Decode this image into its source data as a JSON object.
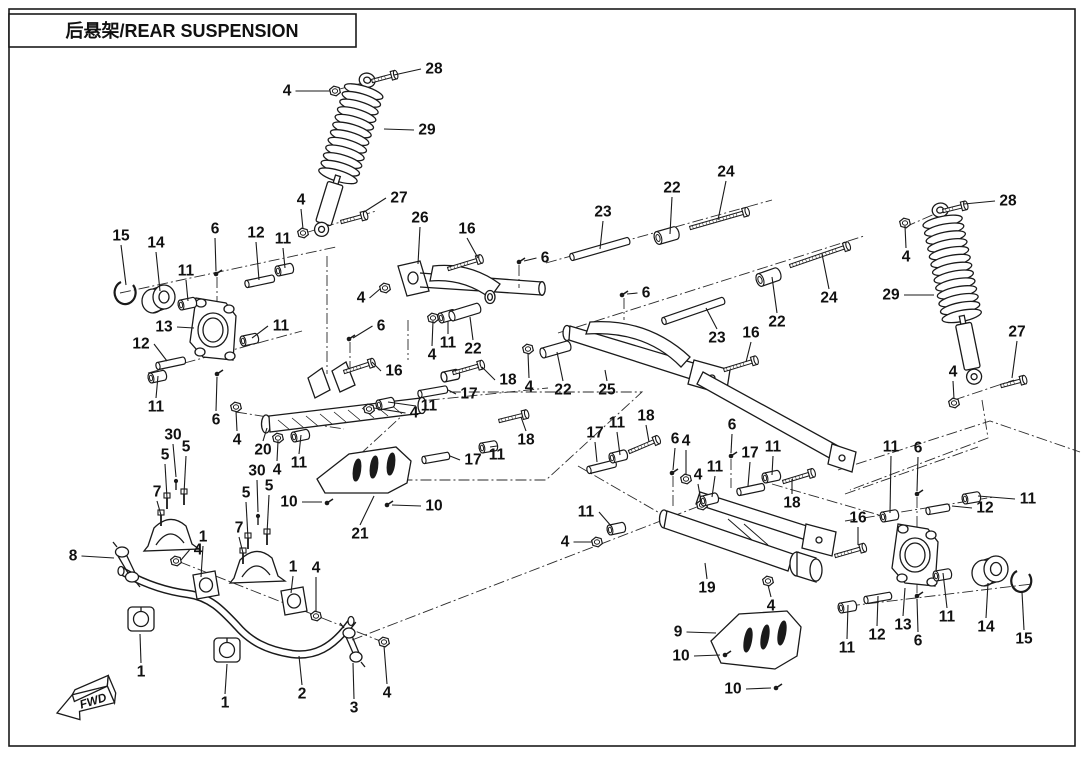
{
  "title": "后悬架/REAR SUSPENSION",
  "fwd_label": "FWD",
  "ink_color": "#1a1a1a",
  "callouts": [
    {
      "n": "28",
      "x": 434,
      "y": 69,
      "tx": 394,
      "ty": 75,
      "part": {
        "t": "bolt",
        "x": 372,
        "y": 81,
        "a": -15,
        "l": 20
      }
    },
    {
      "n": "4",
      "x": 287,
      "y": 91,
      "tx": 330,
      "ty": 91,
      "part": {
        "t": "nut",
        "x": 335,
        "y": 91
      }
    },
    {
      "n": "29",
      "x": 427,
      "y": 130,
      "tx": 384,
      "ty": 129
    },
    {
      "n": "4",
      "x": 301,
      "y": 200,
      "tx": 303,
      "ty": 229,
      "part": {
        "t": "nut",
        "x": 303,
        "y": 233
      }
    },
    {
      "n": "27",
      "x": 399,
      "y": 198,
      "tx": 364,
      "ty": 212,
      "part": {
        "t": "bolt",
        "x": 341,
        "y": 222,
        "a": -15,
        "l": 21
      }
    },
    {
      "n": "26",
      "x": 420,
      "y": 218,
      "tx": 418,
      "ty": 264
    },
    {
      "n": "16",
      "x": 467,
      "y": 229,
      "tx": 478,
      "ty": 258,
      "part": {
        "t": "bolt",
        "x": 448,
        "y": 269,
        "a": -17,
        "l": 30
      }
    },
    {
      "n": "6",
      "x": 545,
      "y": 258,
      "tx": 524,
      "ty": 261,
      "part": {
        "t": "screw",
        "x": 519,
        "y": 262
      }
    },
    {
      "n": "23",
      "x": 603,
      "y": 212,
      "tx": 600,
      "ty": 249,
      "part": {
        "t": "sleeve",
        "x": 572,
        "y": 257,
        "a": -16,
        "l": 58
      }
    },
    {
      "n": "22",
      "x": 672,
      "y": 188,
      "tx": 670,
      "ty": 234,
      "part": {
        "t": "bushing2",
        "x": 658,
        "y": 238,
        "a": -16
      }
    },
    {
      "n": "24",
      "x": 726,
      "y": 172,
      "tx": 718,
      "ty": 220,
      "part": {
        "t": "bolt",
        "x": 690,
        "y": 228,
        "a": -16,
        "l": 55
      }
    },
    {
      "n": "6",
      "x": 646,
      "y": 293,
      "tx": 627,
      "ty": 294,
      "part": {
        "t": "screw",
        "x": 622,
        "y": 295
      }
    },
    {
      "n": "23",
      "x": 717,
      "y": 338,
      "tx": 706,
      "ty": 308,
      "part": {
        "t": "sleeve",
        "x": 664,
        "y": 321,
        "a": -19,
        "l": 62
      }
    },
    {
      "n": "22",
      "x": 777,
      "y": 322,
      "tx": 772,
      "ty": 277,
      "part": {
        "t": "bushing2",
        "x": 760,
        "y": 280,
        "a": -19
      }
    },
    {
      "n": "24",
      "x": 829,
      "y": 298,
      "tx": 822,
      "ty": 254,
      "part": {
        "t": "bolt",
        "x": 790,
        "y": 266,
        "a": -19,
        "l": 57
      }
    },
    {
      "n": "16",
      "x": 751,
      "y": 333,
      "tx": 746,
      "ty": 362,
      "part": {
        "t": "bolt",
        "x": 724,
        "y": 370,
        "a": -17,
        "l": 29
      }
    },
    {
      "n": "28",
      "x": 1008,
      "y": 201,
      "tx": 964,
      "ty": 204,
      "part": {
        "t": "bolt",
        "x": 943,
        "y": 211,
        "a": -14,
        "l": 19
      }
    },
    {
      "n": "4",
      "x": 906,
      "y": 257,
      "tx": 905,
      "ty": 226,
      "part": {
        "t": "nut",
        "x": 905,
        "y": 223
      }
    },
    {
      "n": "29",
      "x": 891,
      "y": 295,
      "tx": 934,
      "ty": 295
    },
    {
      "n": "27",
      "x": 1017,
      "y": 332,
      "tx": 1012,
      "ty": 378,
      "part": {
        "t": "bolt",
        "x": 1001,
        "y": 386,
        "a": -15,
        "l": 20
      }
    },
    {
      "n": "4",
      "x": 953,
      "y": 372,
      "tx": 954,
      "ty": 399,
      "part": {
        "t": "nut",
        "x": 954,
        "y": 403
      }
    },
    {
      "n": "15",
      "x": 121,
      "y": 236,
      "tx": 126,
      "ty": 285
    },
    {
      "n": "14",
      "x": 156,
      "y": 243,
      "tx": 160,
      "ty": 291
    },
    {
      "n": "11",
      "x": 186,
      "y": 271,
      "tx": 188,
      "ty": 301,
      "part": {
        "t": "bushing",
        "x": 181,
        "y": 305,
        "a": -12
      }
    },
    {
      "n": "6",
      "x": 215,
      "y": 229,
      "tx": 216,
      "ty": 271,
      "part": {
        "t": "screw",
        "x": 216,
        "y": 274
      }
    },
    {
      "n": "12",
      "x": 256,
      "y": 233,
      "tx": 259,
      "ty": 280,
      "part": {
        "t": "sleeve",
        "x": 247,
        "y": 284,
        "a": -12,
        "l": 26
      }
    },
    {
      "n": "11",
      "x": 283,
      "y": 239,
      "tx": 285,
      "ty": 268,
      "part": {
        "t": "bushing",
        "x": 278,
        "y": 271,
        "a": -12
      }
    },
    {
      "n": "13",
      "x": 164,
      "y": 327,
      "tx": 194,
      "ty": 328
    },
    {
      "n": "11",
      "x": 281,
      "y": 326,
      "tx": 252,
      "ty": 338,
      "part": {
        "t": "bushing",
        "x": 243,
        "y": 341,
        "a": -12
      }
    },
    {
      "n": "12",
      "x": 141,
      "y": 344,
      "tx": 167,
      "ty": 361,
      "part": {
        "t": "sleeve",
        "x": 158,
        "y": 366,
        "a": -12,
        "l": 26
      }
    },
    {
      "n": "11",
      "x": 156,
      "y": 407,
      "tx": 158,
      "ty": 376,
      "part": {
        "t": "bushing",
        "x": 151,
        "y": 378,
        "a": -12
      }
    },
    {
      "n": "6",
      "x": 216,
      "y": 420,
      "tx": 217,
      "ty": 377,
      "part": {
        "t": "screw",
        "x": 217,
        "y": 374
      }
    },
    {
      "n": "4",
      "x": 361,
      "y": 298,
      "tx": 380,
      "ty": 289,
      "part": {
        "t": "nut",
        "x": 385,
        "y": 288
      }
    },
    {
      "n": "6",
      "x": 381,
      "y": 326,
      "tx": 353,
      "ty": 338,
      "part": {
        "t": "screw",
        "x": 349,
        "y": 339
      }
    },
    {
      "n": "16",
      "x": 394,
      "y": 371,
      "tx": 372,
      "ty": 362,
      "part": {
        "t": "bolt",
        "x": 344,
        "y": 372,
        "a": -18,
        "l": 26
      }
    },
    {
      "n": "4",
      "x": 432,
      "y": 355,
      "tx": 433,
      "ty": 321,
      "part": {
        "t": "nut",
        "x": 433,
        "y": 318
      }
    },
    {
      "n": "11",
      "x": 448,
      "y": 343,
      "tx": 448,
      "ty": 321,
      "part": {
        "t": "bushing",
        "x": 441,
        "y": 318,
        "a": -16
      }
    },
    {
      "n": "22",
      "x": 473,
      "y": 349,
      "tx": 470,
      "ty": 317,
      "part": {
        "t": "sleeve2",
        "x": 452,
        "y": 316,
        "a": -17,
        "l": 27
      }
    },
    {
      "n": "18",
      "x": 508,
      "y": 380,
      "tx": 482,
      "ty": 367,
      "part": {
        "t": "bolt",
        "x": 453,
        "y": 373,
        "a": -16,
        "l": 26
      }
    },
    {
      "n": "17",
      "x": 469,
      "y": 394,
      "tx": 448,
      "ty": 390,
      "part": {
        "t": "sleeve",
        "x": 420,
        "y": 394,
        "a": -10,
        "l": 26
      }
    },
    {
      "n": "4",
      "x": 529,
      "y": 387,
      "tx": 528,
      "ty": 353,
      "part": {
        "t": "nut",
        "x": 528,
        "y": 349
      }
    },
    {
      "n": "22",
      "x": 563,
      "y": 390,
      "tx": 557,
      "ty": 352,
      "part": {
        "t": "sleeve2",
        "x": 543,
        "y": 353,
        "a": -16,
        "l": 26
      }
    },
    {
      "n": "11",
      "x": 429,
      "y": 406,
      "tx": 388,
      "ty": 402,
      "part": {
        "t": "bushing",
        "x": 379,
        "y": 405,
        "a": -12
      }
    },
    {
      "n": "4",
      "x": 414,
      "y": 413,
      "tx": 374,
      "ty": 408,
      "part": {
        "t": "nut",
        "x": 369,
        "y": 409
      }
    },
    {
      "n": "4",
      "x": 237,
      "y": 440,
      "tx": 236,
      "ty": 411,
      "part": {
        "t": "nut",
        "x": 236,
        "y": 407
      }
    },
    {
      "n": "20",
      "x": 263,
      "y": 450,
      "tx": 267,
      "ty": 428
    },
    {
      "n": "11",
      "x": 299,
      "y": 463,
      "tx": 301,
      "ty": 435,
      "part": {
        "t": "bushing",
        "x": 294,
        "y": 437,
        "a": -12
      }
    },
    {
      "n": "4",
      "x": 277,
      "y": 470,
      "tx": 278,
      "ty": 441,
      "part": {
        "t": "nut",
        "x": 278,
        "y": 438
      }
    },
    {
      "n": "10",
      "x": 289,
      "y": 502,
      "tx": 322,
      "ty": 502,
      "part": {
        "t": "screw",
        "x": 327,
        "y": 503
      }
    },
    {
      "n": "10",
      "x": 434,
      "y": 506,
      "tx": 392,
      "ty": 505,
      "part": {
        "t": "screw",
        "x": 387,
        "y": 505
      }
    },
    {
      "n": "21",
      "x": 360,
      "y": 534,
      "tx": 374,
      "ty": 496
    },
    {
      "n": "17",
      "x": 473,
      "y": 460,
      "tx": 450,
      "ty": 456,
      "part": {
        "t": "sleeve",
        "x": 424,
        "y": 460,
        "a": -10,
        "l": 24
      }
    },
    {
      "n": "11",
      "x": 497,
      "y": 455,
      "tx": 490,
      "ty": 447,
      "part": {
        "t": "bushing",
        "x": 482,
        "y": 448,
        "a": -10
      }
    },
    {
      "n": "18",
      "x": 526,
      "y": 440,
      "tx": 521,
      "ty": 417,
      "part": {
        "t": "bolt",
        "x": 499,
        "y": 421,
        "a": -14,
        "l": 24
      }
    },
    {
      "n": "30",
      "x": 257,
      "y": 471,
      "tx": 258,
      "ty": 512,
      "part": {
        "t": "pin",
        "x": 258,
        "y": 516
      }
    },
    {
      "n": "5",
      "x": 246,
      "y": 493,
      "tx": 248,
      "ty": 538,
      "part": {
        "t": "vbolt",
        "x": 248,
        "y": 542
      }
    },
    {
      "n": "5",
      "x": 269,
      "y": 486,
      "tx": 267,
      "ty": 534,
      "part": {
        "t": "vbolt",
        "x": 267,
        "y": 538
      }
    },
    {
      "n": "7",
      "x": 239,
      "y": 528,
      "tx": 243,
      "ty": 553,
      "part": {
        "t": "vbolt",
        "x": 243,
        "y": 557
      }
    },
    {
      "n": "30",
      "x": 173,
      "y": 435,
      "tx": 176,
      "ty": 477,
      "part": {
        "t": "pin",
        "x": 176,
        "y": 481
      }
    },
    {
      "n": "5",
      "x": 165,
      "y": 455,
      "tx": 167,
      "ty": 498,
      "part": {
        "t": "vbolt",
        "x": 167,
        "y": 502
      }
    },
    {
      "n": "5",
      "x": 186,
      "y": 447,
      "tx": 184,
      "ty": 494,
      "part": {
        "t": "vbolt",
        "x": 184,
        "y": 498
      }
    },
    {
      "n": "7",
      "x": 157,
      "y": 492,
      "tx": 161,
      "ty": 515,
      "part": {
        "t": "vbolt",
        "x": 161,
        "y": 519
      }
    },
    {
      "n": "8",
      "x": 73,
      "y": 556,
      "tx": 114,
      "ty": 558
    },
    {
      "n": "1",
      "x": 203,
      "y": 537,
      "tx": 201,
      "ty": 577
    },
    {
      "n": "4",
      "x": 198,
      "y": 550,
      "tx": 181,
      "ty": 560,
      "part": {
        "t": "nut",
        "x": 176,
        "y": 561
      }
    },
    {
      "n": "1",
      "x": 293,
      "y": 567,
      "tx": 291,
      "ty": 593
    },
    {
      "n": "4",
      "x": 316,
      "y": 568,
      "tx": 316,
      "ty": 612,
      "part": {
        "t": "nut",
        "x": 316,
        "y": 616
      }
    },
    {
      "n": "1",
      "x": 141,
      "y": 672,
      "tx": 140,
      "ty": 634
    },
    {
      "n": "1",
      "x": 225,
      "y": 703,
      "tx": 227,
      "ty": 664
    },
    {
      "n": "2",
      "x": 302,
      "y": 694,
      "tx": 299,
      "ty": 656
    },
    {
      "n": "3",
      "x": 354,
      "y": 708,
      "tx": 353,
      "ty": 663
    },
    {
      "n": "4",
      "x": 387,
      "y": 693,
      "tx": 384,
      "ty": 646,
      "part": {
        "t": "nut",
        "x": 384,
        "y": 642
      }
    },
    {
      "n": "25",
      "x": 607,
      "y": 390,
      "tx": 605,
      "ty": 370
    },
    {
      "n": "17",
      "x": 595,
      "y": 433,
      "tx": 597,
      "ty": 462,
      "part": {
        "t": "sleeve",
        "x": 589,
        "y": 470,
        "a": -14,
        "l": 26
      }
    },
    {
      "n": "11",
      "x": 617,
      "y": 423,
      "tx": 620,
      "ty": 455,
      "part": {
        "t": "bushing",
        "x": 612,
        "y": 458,
        "a": -14
      }
    },
    {
      "n": "18",
      "x": 646,
      "y": 416,
      "tx": 649,
      "ty": 442,
      "part": {
        "t": "bolt",
        "x": 629,
        "y": 452,
        "a": -23,
        "l": 27
      }
    },
    {
      "n": "6",
      "x": 675,
      "y": 439,
      "tx": 673,
      "ty": 470,
      "part": {
        "t": "screw",
        "x": 672,
        "y": 473
      }
    },
    {
      "n": "4",
      "x": 686,
      "y": 441,
      "tx": 686,
      "ty": 475,
      "part": {
        "t": "nut",
        "x": 686,
        "y": 479
      }
    },
    {
      "n": "6",
      "x": 732,
      "y": 425,
      "tx": 731,
      "ty": 453,
      "part": {
        "t": "screw",
        "x": 731,
        "y": 456
      }
    },
    {
      "n": "4",
      "x": 698,
      "y": 475,
      "tx": 701,
      "ty": 501,
      "part": {
        "t": "nut",
        "x": 702,
        "y": 505
      }
    },
    {
      "n": "11",
      "x": 715,
      "y": 467,
      "tx": 712,
      "ty": 497,
      "part": {
        "t": "bushing",
        "x": 703,
        "y": 501,
        "a": -14
      }
    },
    {
      "n": "17",
      "x": 750,
      "y": 453,
      "tx": 748,
      "ty": 486,
      "part": {
        "t": "sleeve",
        "x": 739,
        "y": 492,
        "a": -12,
        "l": 24
      }
    },
    {
      "n": "11",
      "x": 773,
      "y": 447,
      "tx": 772,
      "ty": 475,
      "part": {
        "t": "bushing",
        "x": 765,
        "y": 478,
        "a": -12
      }
    },
    {
      "n": "18",
      "x": 792,
      "y": 503,
      "tx": 792,
      "ty": 479,
      "part": {
        "t": "bolt",
        "x": 783,
        "y": 482,
        "a": -17,
        "l": 27
      }
    },
    {
      "n": "11",
      "x": 586,
      "y": 512,
      "tx": 612,
      "ty": 527,
      "part": {
        "t": "bushing",
        "x": 610,
        "y": 530,
        "a": -12
      }
    },
    {
      "n": "4",
      "x": 565,
      "y": 542,
      "tx": 592,
      "ty": 542,
      "part": {
        "t": "nut",
        "x": 597,
        "y": 542
      }
    },
    {
      "n": "19",
      "x": 707,
      "y": 588,
      "tx": 705,
      "ty": 563
    },
    {
      "n": "4",
      "x": 771,
      "y": 606,
      "tx": 768,
      "ty": 585,
      "part": {
        "t": "nut",
        "x": 768,
        "y": 581
      }
    },
    {
      "n": "9",
      "x": 678,
      "y": 632,
      "tx": 716,
      "ty": 633
    },
    {
      "n": "10",
      "x": 681,
      "y": 656,
      "tx": 720,
      "ty": 655,
      "part": {
        "t": "screw",
        "x": 725,
        "y": 655
      }
    },
    {
      "n": "10",
      "x": 733,
      "y": 689,
      "tx": 771,
      "ty": 688,
      "part": {
        "t": "screw",
        "x": 776,
        "y": 688
      }
    },
    {
      "n": "11",
      "x": 891,
      "y": 447,
      "tx": 890,
      "ty": 513,
      "part": {
        "t": "bushing",
        "x": 883,
        "y": 517,
        "a": -10
      }
    },
    {
      "n": "6",
      "x": 918,
      "y": 448,
      "tx": 917,
      "ty": 491,
      "part": {
        "t": "screw",
        "x": 917,
        "y": 494
      }
    },
    {
      "n": "16",
      "x": 858,
      "y": 518,
      "tx": 858,
      "ty": 545,
      "part": {
        "t": "bolt",
        "x": 835,
        "y": 556,
        "a": -16,
        "l": 26
      }
    },
    {
      "n": "11",
      "x": 1028,
      "y": 499,
      "tx": 978,
      "ty": 496,
      "part": {
        "t": "bushing",
        "x": 965,
        "y": 499,
        "a": -10
      }
    },
    {
      "n": "12",
      "x": 985,
      "y": 508,
      "tx": 952,
      "ty": 506,
      "part": {
        "t": "sleeve",
        "x": 928,
        "y": 511,
        "a": -10,
        "l": 20
      }
    },
    {
      "n": "11",
      "x": 847,
      "y": 648,
      "tx": 848,
      "ty": 605,
      "part": {
        "t": "bushing",
        "x": 841,
        "y": 608,
        "a": -10
      }
    },
    {
      "n": "12",
      "x": 877,
      "y": 635,
      "tx": 878,
      "ty": 596,
      "part": {
        "t": "sleeve",
        "x": 866,
        "y": 600,
        "a": -10,
        "l": 24
      }
    },
    {
      "n": "13",
      "x": 903,
      "y": 625,
      "tx": 905,
      "ty": 588
    },
    {
      "n": "6",
      "x": 918,
      "y": 641,
      "tx": 917,
      "ty": 599,
      "part": {
        "t": "screw",
        "x": 917,
        "y": 596
      }
    },
    {
      "n": "11",
      "x": 947,
      "y": 617,
      "tx": 943,
      "ty": 573,
      "part": {
        "t": "bushing",
        "x": 936,
        "y": 576,
        "a": -10
      }
    },
    {
      "n": "14",
      "x": 986,
      "y": 627,
      "tx": 988,
      "ty": 583
    },
    {
      "n": "15",
      "x": 1024,
      "y": 639,
      "tx": 1022,
      "ty": 592
    }
  ]
}
